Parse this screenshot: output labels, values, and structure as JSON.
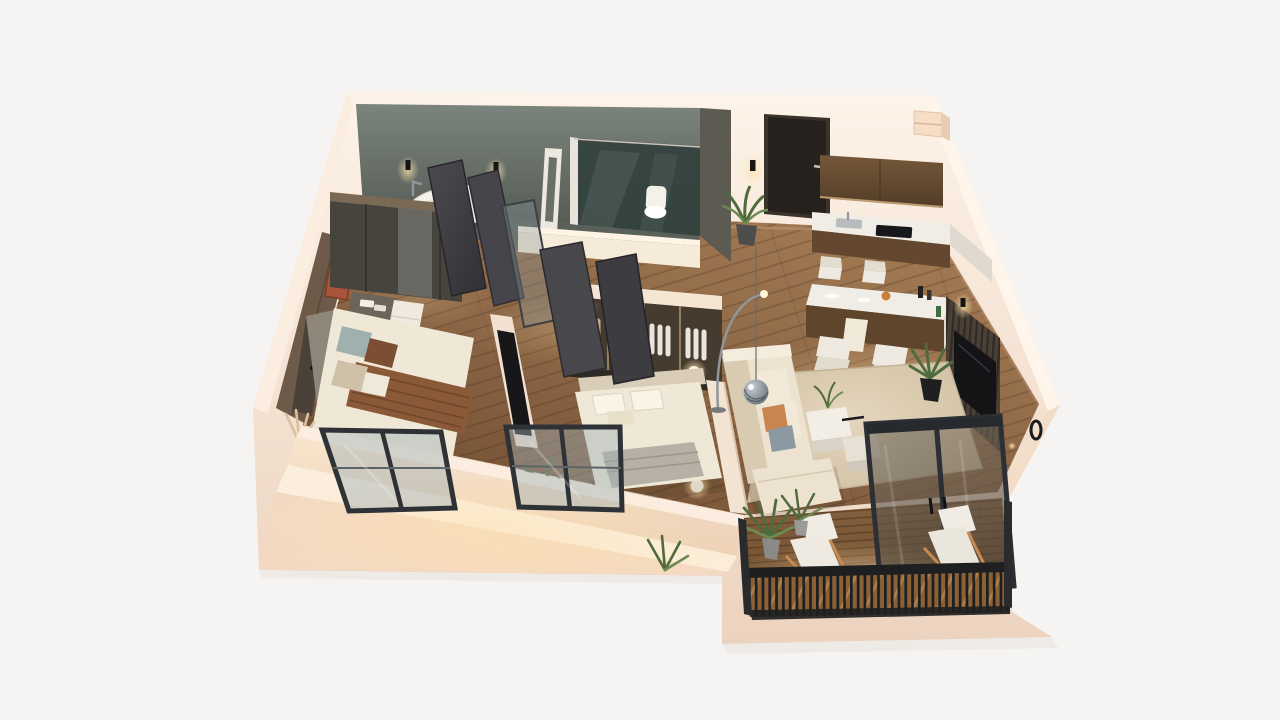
{
  "meta": {
    "title": "3D Apartment Floor Plan Render",
    "view": "isometric cutaway from above",
    "style": "photorealistic 3d visualization, warm evening lighting"
  },
  "palette": {
    "background": "#f5f4f2",
    "wall_light": "#fdf3e8",
    "wall_cream": "#f7e7d8",
    "wall_shadow": "#ecd3bf",
    "wall_front": "#f8e5cc",
    "bath_wall": "#7b847d",
    "bath_wall_dark": "#525952",
    "bath_floor": "#59615a",
    "shower_glass": "#33413e",
    "wood_light": "#a67d55",
    "wood_mid": "#8b6544",
    "wood_dark": "#6f4d31",
    "cabinet_wood": "#74573a",
    "cabinet_dark": "#533d27",
    "island_wood": "#5f452c",
    "marble": "#f0ede7",
    "marble_face": "#dfd9d0",
    "entry_door": "#26211c",
    "grey_door": "#45454b",
    "wardrobe": "#47433d",
    "closet_front": "#453b2f",
    "closet_trim": "#937f5e",
    "rug_light": "#e4d6bd",
    "rug_dark": "#cdbc9e",
    "sofa": "#ece2cf",
    "sofa_shadow": "#d8cbb2",
    "bed_linen": "#f0e8d7",
    "headboard": "#8e8678",
    "blanket_grey": "#b6b0a5",
    "throw_brown": "#8a5a38",
    "pillow_teal": "#9fb0af",
    "pillow_brown": "#7c4e33",
    "tv_black": "#141416",
    "media_wall": "#4a4036",
    "deck_light": "#85613e",
    "deck_dark": "#6b4a2c",
    "railing": "#1e1f21",
    "rail_wood": "#8a6136",
    "glass_tint": "#9fb0b5",
    "glass_frame": "#2e3236",
    "plant_green": "#4f6b3d",
    "plant_light": "#6c8b52",
    "pot_dark": "#1f1f21",
    "pot_grey": "#8a8a88",
    "accent_rust": "#a9543a",
    "glow": "#ffe2ae",
    "white_goods": "#f4f1ea",
    "chair_white": "#efeae1",
    "chair_frame": "#c98a52"
  },
  "rooms": [
    {
      "id": "bathroom",
      "items": [
        "freestanding bathtub",
        "walk-in shower with glass partition",
        "toilet",
        "white vanity",
        "concrete feature walls",
        "two wall sconces",
        "standing mirror frame"
      ]
    },
    {
      "id": "entry-hall",
      "items": [
        "dark entry door",
        "wall sconce",
        "potted plant",
        "storage niche",
        "grey divider column"
      ]
    },
    {
      "id": "kitchen",
      "items": [
        "walnut upper cabinets",
        "marble counter with sink and cooktop",
        "marble breakfast bar with waterfall end",
        "four white bar chairs",
        "decor bottles",
        "fruit bowl"
      ]
    },
    {
      "id": "living-room",
      "items": [
        "l-shaped cream sofa",
        "orange and grey cushions",
        "two cube coffee tables",
        "textured area rug",
        "mirror ball pendant",
        "arc floor lamp",
        "slatted media wall with tv",
        "potted plant",
        "wall sconce"
      ]
    },
    {
      "id": "bedroom-1",
      "items": [
        "double bed with brown throw",
        "teal and brown pillows",
        "grey headboard",
        "dark mirrored wardrobe",
        "bedside tables with towels",
        "wall mounted tv",
        "pampas grass vase",
        "rust artwork",
        "tilted front window"
      ]
    },
    {
      "id": "bedroom-2",
      "items": [
        "double bed with grey foot blanket",
        "cream pillows",
        "two glowing sphere lamps",
        "tilted front window",
        "small plant"
      ]
    },
    {
      "id": "walk-in-closet",
      "items": [
        "bronze glass front wardrobe",
        "hanging clothes",
        "folded linens",
        "dark plinth"
      ]
    },
    {
      "id": "hallway",
      "items": [
        "several open dark grey doors",
        "leaning glass pane"
      ]
    },
    {
      "id": "balcony",
      "items": [
        "timber deck",
        "black slatted railing",
        "two white lounge chairs",
        "two potted palms",
        "tall glass double door"
      ]
    },
    {
      "id": "front-terrace",
      "items": [
        "cream ledge",
        "two tilted window panels",
        "ledge plant",
        "stepped plinth"
      ]
    }
  ]
}
